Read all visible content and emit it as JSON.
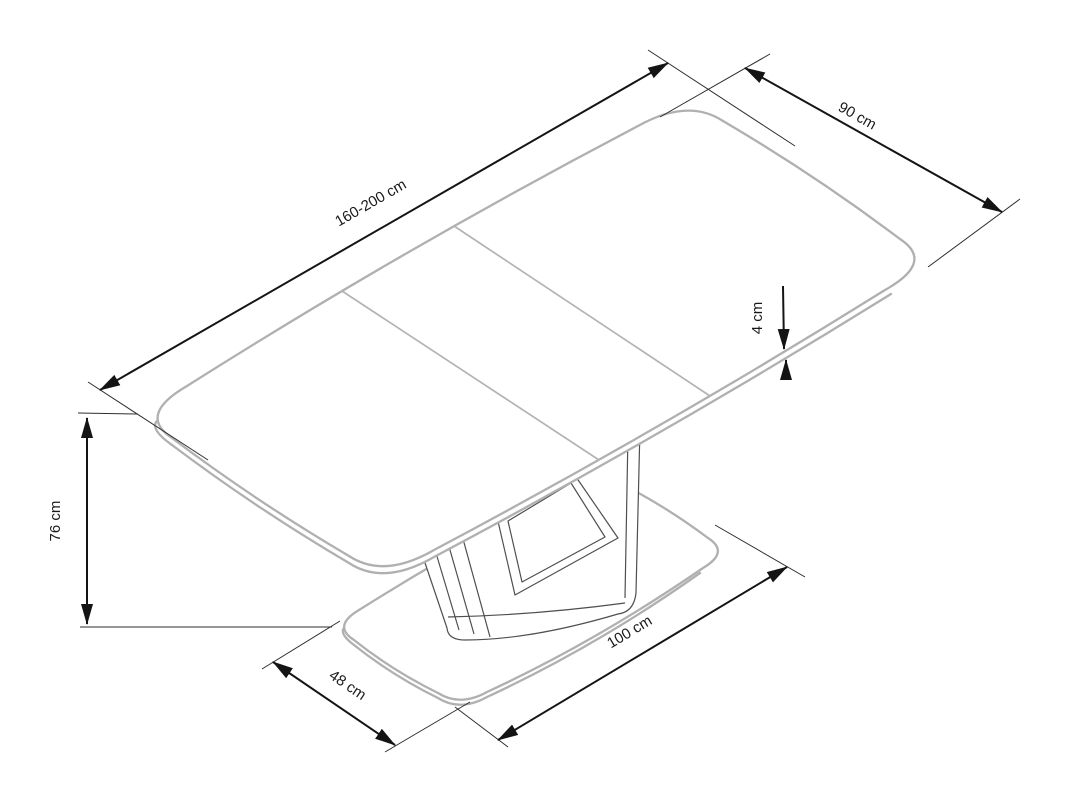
{
  "diagram": {
    "background_color": "#ffffff",
    "furniture_outline_color": "#b0b0b0",
    "pedestal_line_color": "#4f4f4f",
    "dimension_line_color": "#141414",
    "dimensions": {
      "table_length": "160-200 cm",
      "table_width": "90 cm",
      "top_thickness": "4 cm",
      "table_height": "76 cm",
      "base_length": "100 cm",
      "base_width": "48 cm"
    }
  }
}
